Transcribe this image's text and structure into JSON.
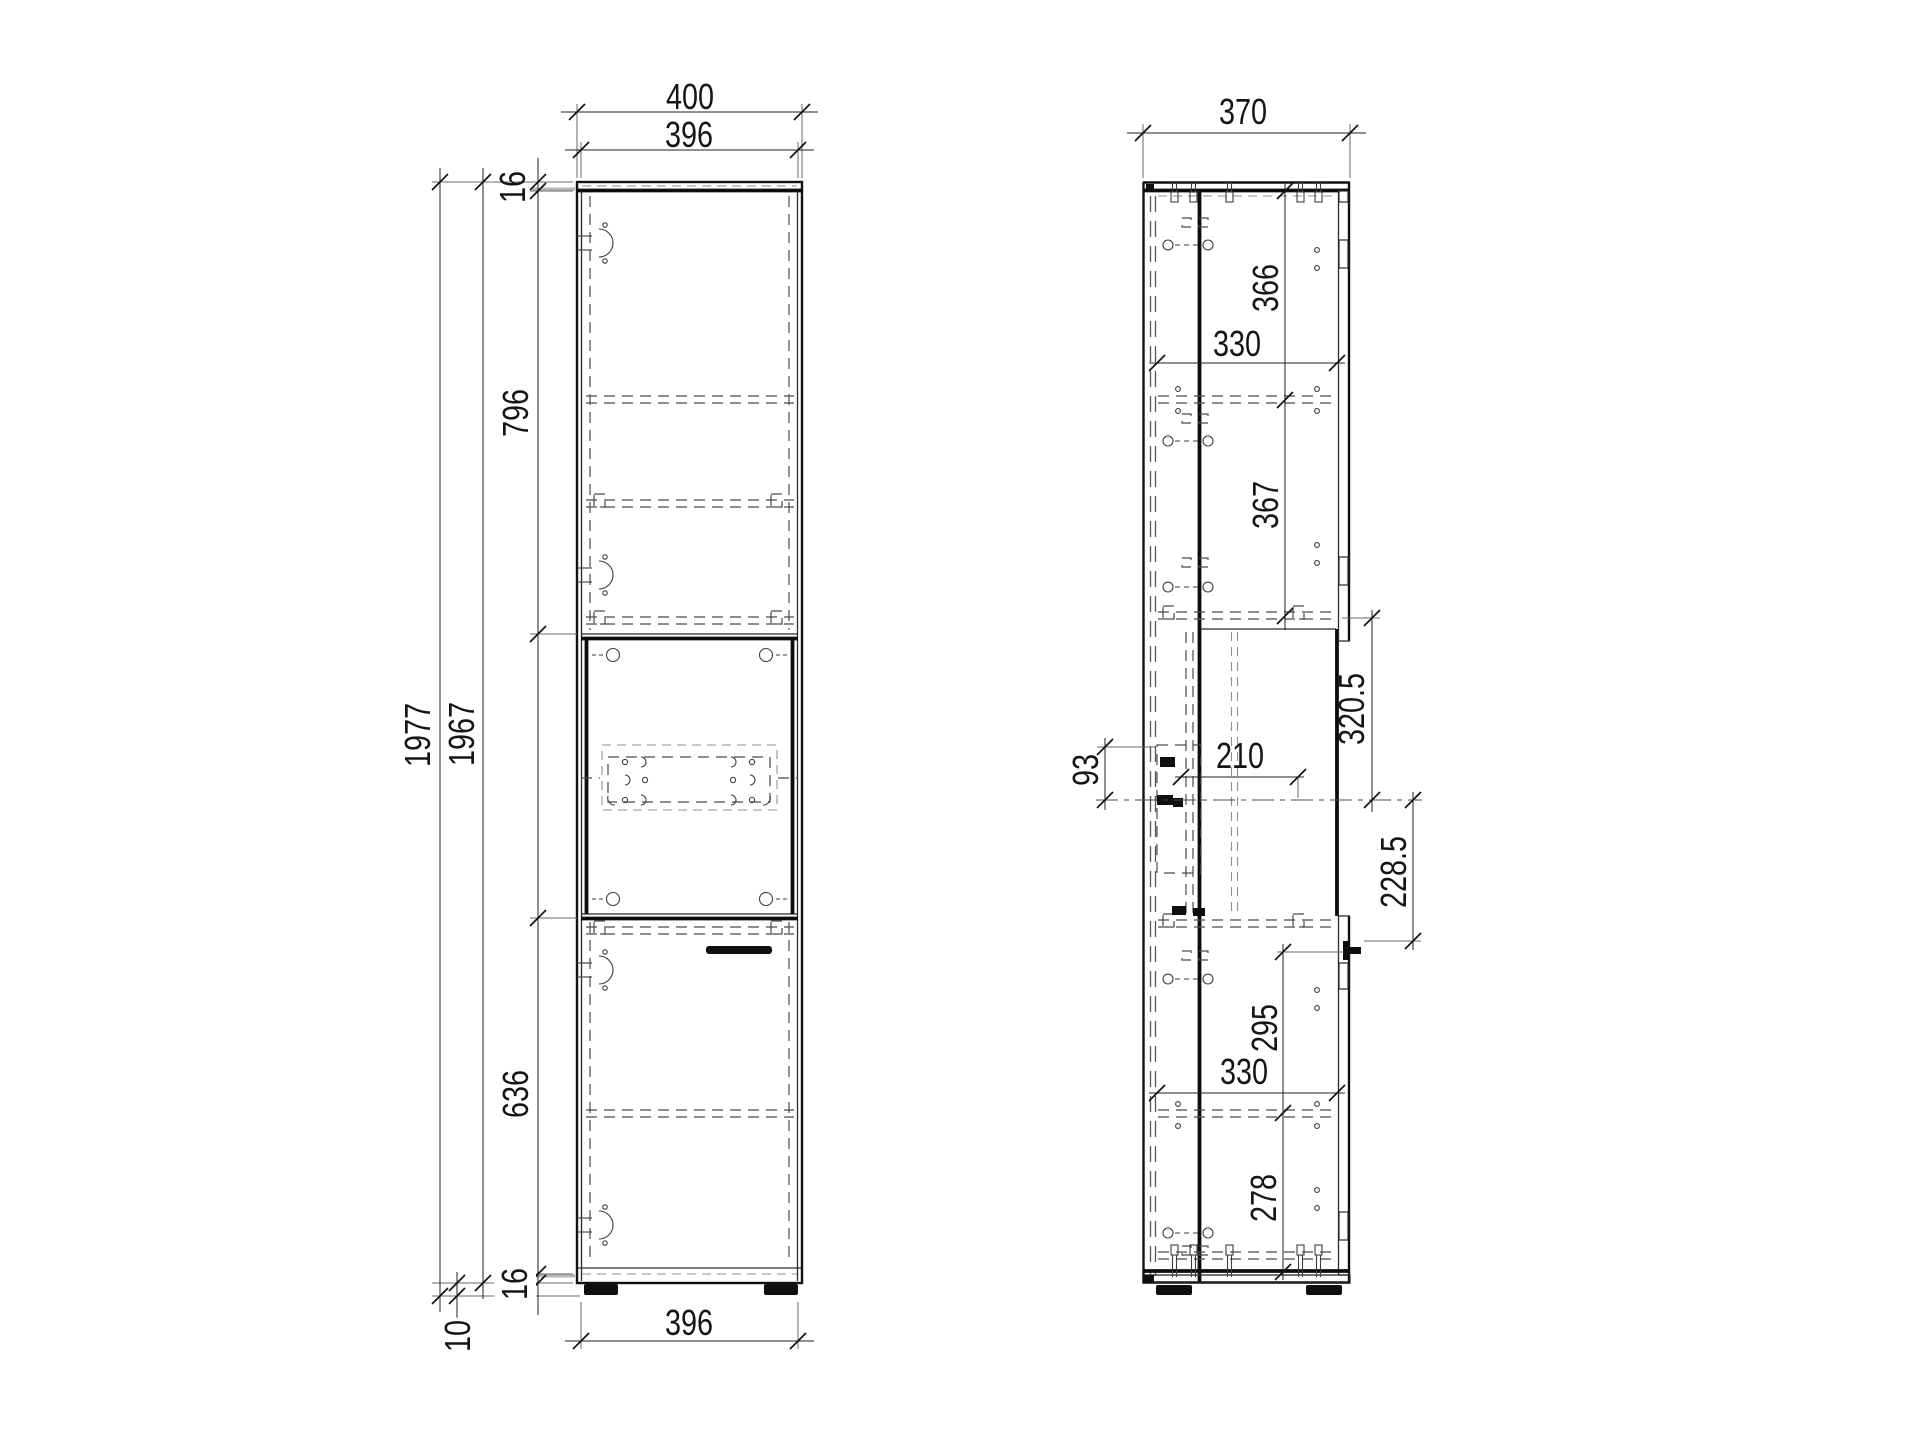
{
  "front_view": {
    "dimensions": {
      "overall_width": "400",
      "door_width_top": "396",
      "top_panel_thickness": "16",
      "upper_door_height": "796",
      "overall_height": "1977",
      "carcass_height": "1967",
      "lower_door_height": "636",
      "bottom_panel_thickness": "16",
      "plinth_height": "10",
      "door_width_bottom": "396"
    }
  },
  "side_view": {
    "dimensions": {
      "overall_depth": "370",
      "top_compartment_height": "366",
      "top_shelf_depth": "330",
      "second_compartment_height": "367",
      "niche_upper_height": "320.5",
      "bracket_height": "93",
      "bracket_depth": "210",
      "niche_lower_height": "228.5",
      "lower_compartment_upper_height": "295",
      "lower_shelf_depth": "330",
      "lower_compartment_height": "278"
    }
  }
}
